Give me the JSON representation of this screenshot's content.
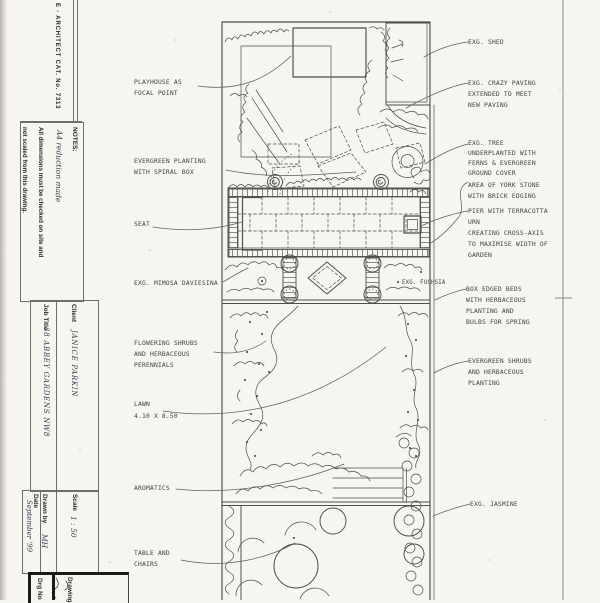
{
  "colors": {
    "paper": "#f7f5f0",
    "ink": "#4d4d4d"
  },
  "title_block": {
    "edge_strip": "E - ARCHITECT CAT. No. 7313",
    "notes_heading": "NOTES:",
    "notes_line1": "All dimensions must be checked on site and",
    "notes_line2": "not scaled from this drawing.",
    "notes_handwritten": "A4 reduction made",
    "client_label": "Client",
    "client_value": "JANICE PARKIN",
    "job_title_label": "Job Title",
    "job_title_value": "38 ABBEY GARDENS NW8",
    "scale_label": "Scale",
    "scale_value": "1 : 50",
    "drawn_by_label": "Drawn by",
    "drawn_by_value": "MH",
    "date_label": "Date",
    "date_value": "September '99",
    "drawing_label": "Drawing",
    "drg_no_label": "Drg No"
  },
  "plan_labels": {
    "left": [
      {
        "lines": [
          "PLAYHOUSE AS",
          "FOCAL POINT"
        ]
      },
      {
        "lines": [
          "EVERGREEN PLANTING",
          "WITH SPIRAL BOX"
        ]
      },
      {
        "lines": [
          "SEAT"
        ]
      },
      {
        "lines": [
          "EXG. MIMOSA DAVIESINA"
        ]
      },
      {
        "lines": [
          "FLOWERING SHRUBS",
          "AND HERBACEOUS",
          "PERENNIALS"
        ]
      },
      {
        "lines": [
          "LAWN",
          "4.10 X 8.50"
        ]
      },
      {
        "lines": [
          "AROMATICS"
        ]
      },
      {
        "lines": [
          "TABLE AND",
          "CHAIRS"
        ]
      }
    ],
    "right": [
      {
        "lines": [
          "EXG. SHED"
        ]
      },
      {
        "lines": [
          "EXG. CRAZY PAVING",
          "EXTENDED TO MEET",
          "NEW PAVING"
        ]
      },
      {
        "lines": [
          "EXG. TREE",
          "UNDERPLANTED WITH",
          "FERNS & EVERGREEN",
          "GROUND COVER"
        ]
      },
      {
        "lines": [
          "AREA OF YORK STONE",
          "WITH BRICK EDGING"
        ]
      },
      {
        "lines": [
          "PIER WITH TERRACOTTA",
          "URN",
          "CREATING CROSS-AXIS",
          "TO MAXIMISE WIDTH OF",
          "GARDEN"
        ]
      },
      {
        "lines": [
          "BOX EDGED BEDS",
          "WITH HERBACEOUS",
          "PLANTING AND",
          "BULBS FOR SPRING"
        ]
      },
      {
        "lines": [
          "EVERGREEN SHRUBS",
          "AND HERBACEOUS",
          "PLANTING"
        ]
      },
      {
        "lines": [
          "EXG. JASMINE"
        ]
      }
    ],
    "fuchsia": "EXG. FUCHSIA"
  }
}
